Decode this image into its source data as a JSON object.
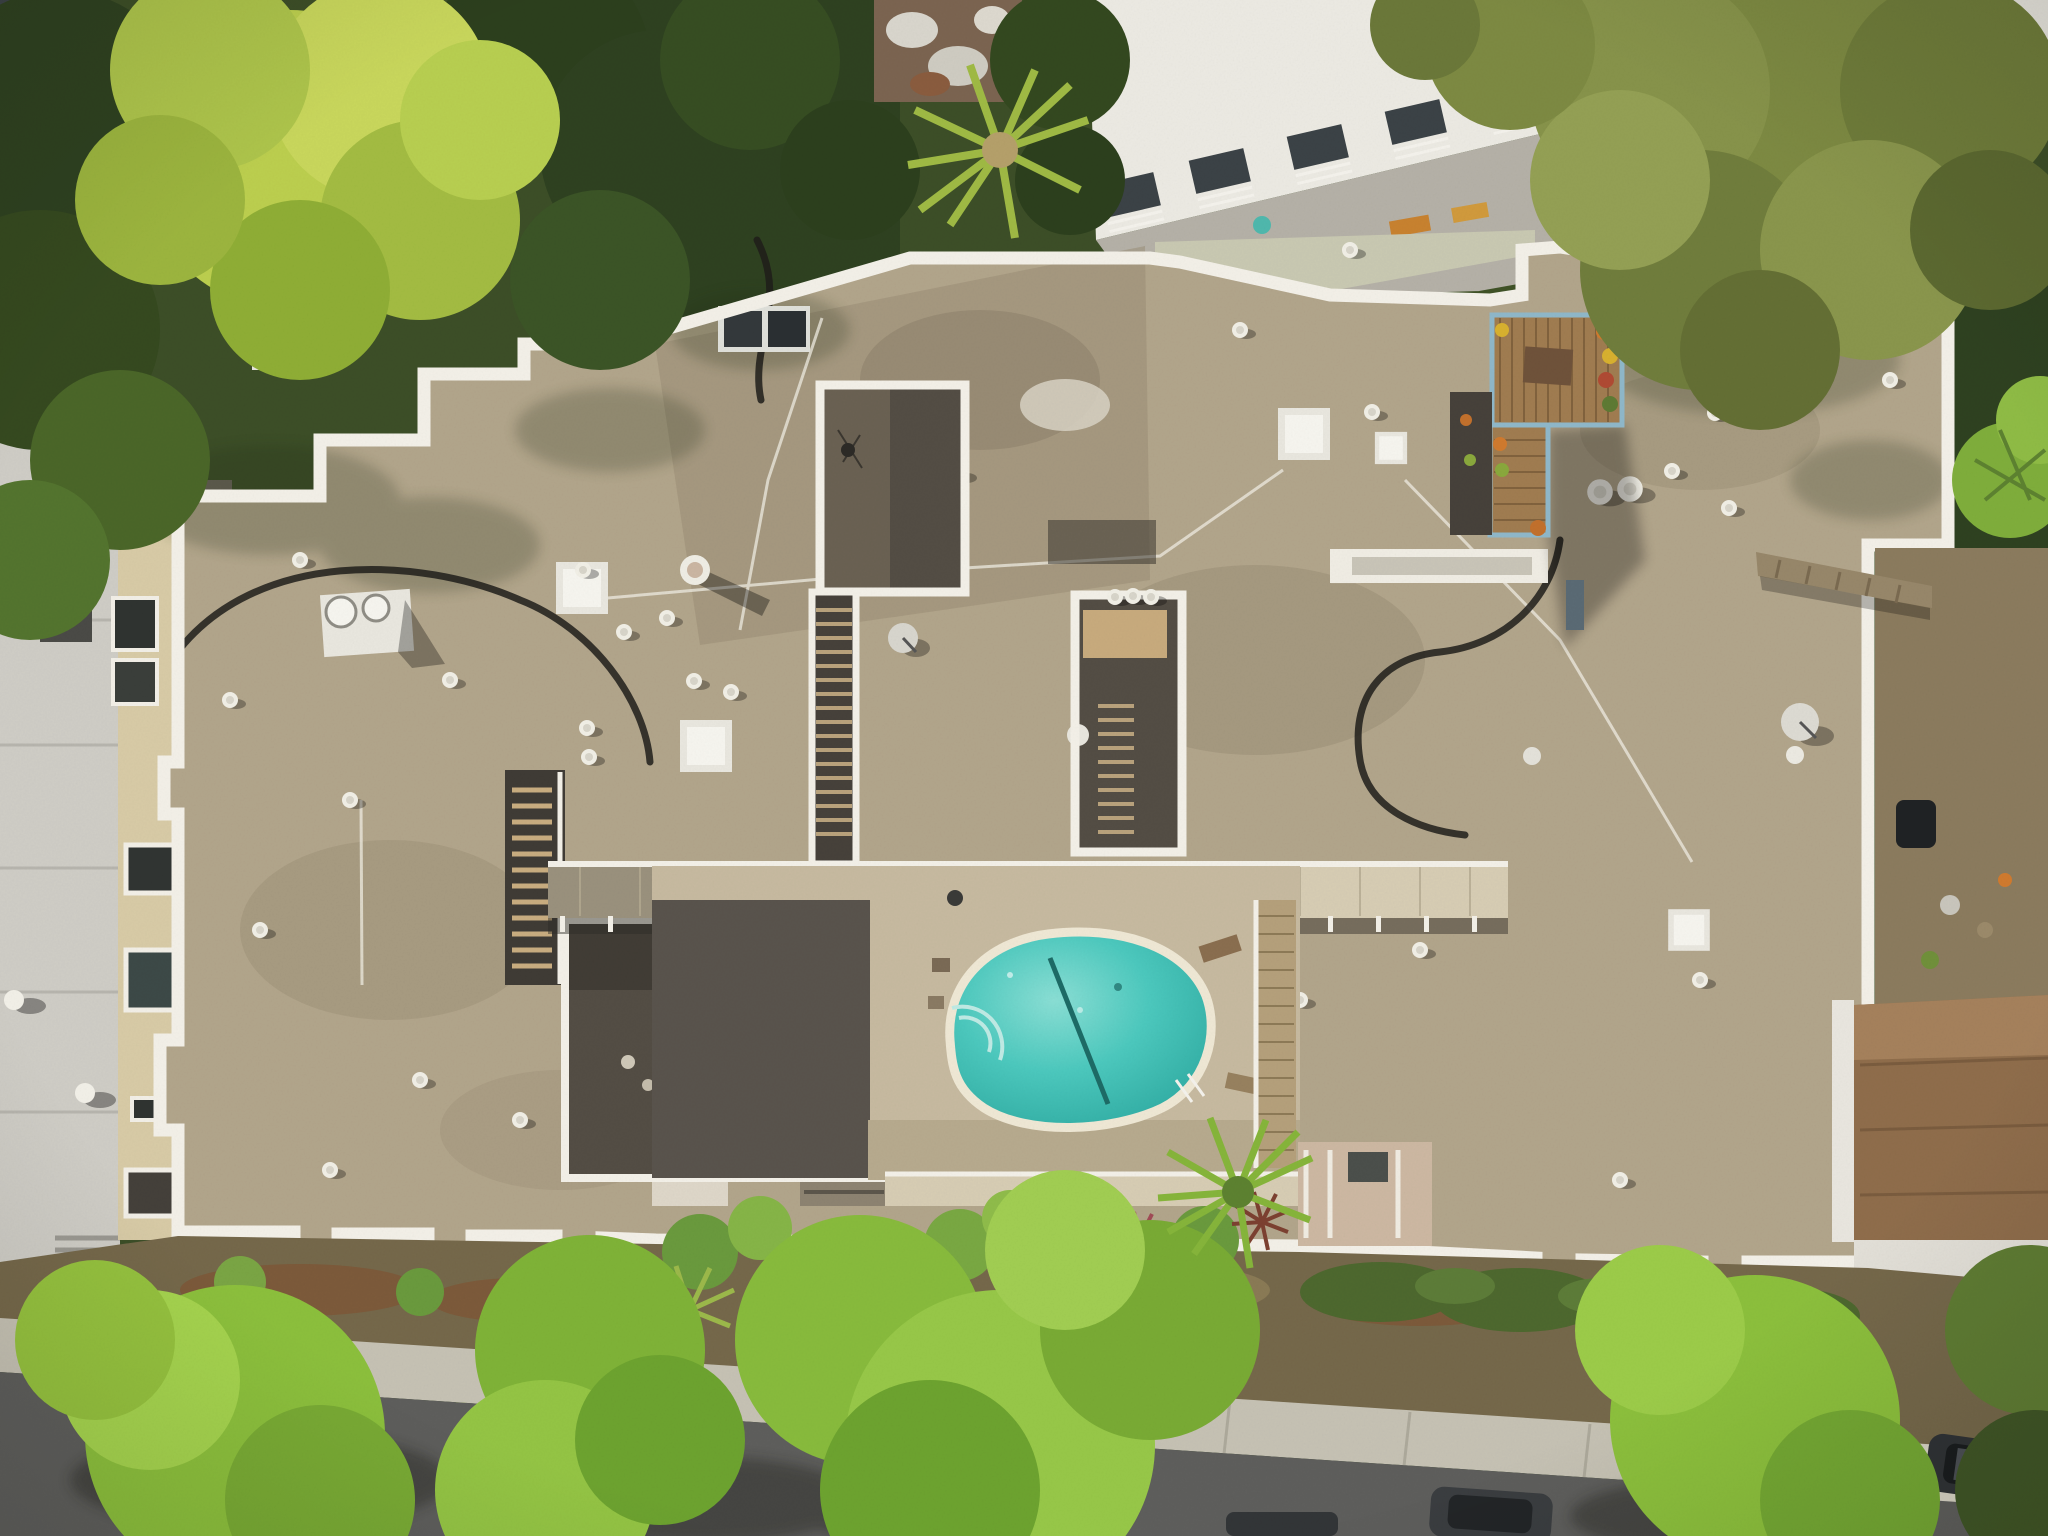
{
  "meta": {
    "title": "Aerial drone photograph, top-down view of a flat-roofed apartment complex with courtyard swimming pool on a tree-lined street",
    "width_px": 2048,
    "height_px": 1536
  },
  "palette": {
    "forest": "#3c4e27",
    "treeBright": "#95c23e",
    "treeYellow": "#bccf4e",
    "treeOlive": "#7d8a42",
    "treeDark": "#2e4120",
    "gravel": "#b2a58b",
    "gravelDark": "#988b73",
    "parapet": "#f3f0e8",
    "courtyard": "#534d44",
    "pool": "#3ec3b8",
    "poolDeep": "#2aa79e",
    "coping": "#efe8d5",
    "poolDeck": "#c7baa0",
    "corridor": "#d7cdb4",
    "wood": "#a07c50",
    "woodLight": "#c8ab7d",
    "street": "#5e5e5c",
    "sidewalk": "#c6c2b4",
    "garden": "#75684a",
    "hedge": "#4d682e",
    "mulch": "#7c5a3a",
    "grayRoof": "#cfcdc6",
    "beige": "#d8cba6",
    "whiteBldg": "#eceae3",
    "roofBand": "#dcdbd3",
    "shingle": "#8f6d4b",
    "dirtYard": "#8b7b5e",
    "brick": "#9a6a52",
    "carDark": "#2f3235",
    "railBlue": "#8fb8ca",
    "oldRoof": "#7b6450"
  },
  "scene": {
    "elements": [
      {
        "name": "main-apartment-roof",
        "label": "Tan gravel flat roof with white parapets"
      },
      {
        "name": "swimming-pool",
        "label": "Kidney-shaped turquoise pool with lane rope and ladder"
      },
      {
        "name": "rooftop-deck",
        "label": "Wood roof deck with planters and pale blue railing"
      },
      {
        "name": "courtyards",
        "label": "Recessed courtyards with wooden stairs and walkway bridges"
      },
      {
        "name": "north-condo-building",
        "label": "White modern condo building with balconies and patio"
      },
      {
        "name": "west-neighbor",
        "label": "Gray concrete roof and beige building with windows"
      },
      {
        "name": "east-neighbor-house",
        "label": "Brown shingle-roof house with yard and fallen palm trunk"
      },
      {
        "name": "street",
        "label": "Tree-lined street with parked cars and sidewalk"
      }
    ]
  }
}
